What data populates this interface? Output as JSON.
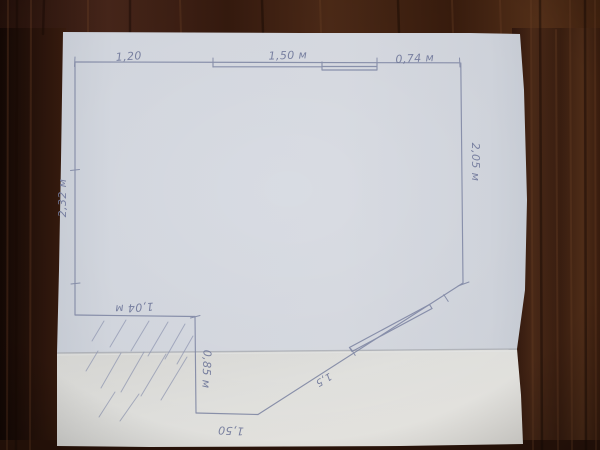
{
  "plan": {
    "labels": {
      "top_left": "1,20",
      "top_middle": "1,50 м",
      "top_right": "0,74 м",
      "right_wall": "2,05 м",
      "left_wall": "2,32 м",
      "notch_top": "1,04 м",
      "notch_side": "0,85 м",
      "bottom_wall": "1,50",
      "diagonal_wall": "1,5"
    },
    "colors": {
      "pencil": "#8088a6",
      "paper_upper": "#d8dbe2",
      "paper_lower": "#e5e5e2",
      "wood_dark": "#2e1710",
      "wood_mid": "#3f2213"
    }
  }
}
